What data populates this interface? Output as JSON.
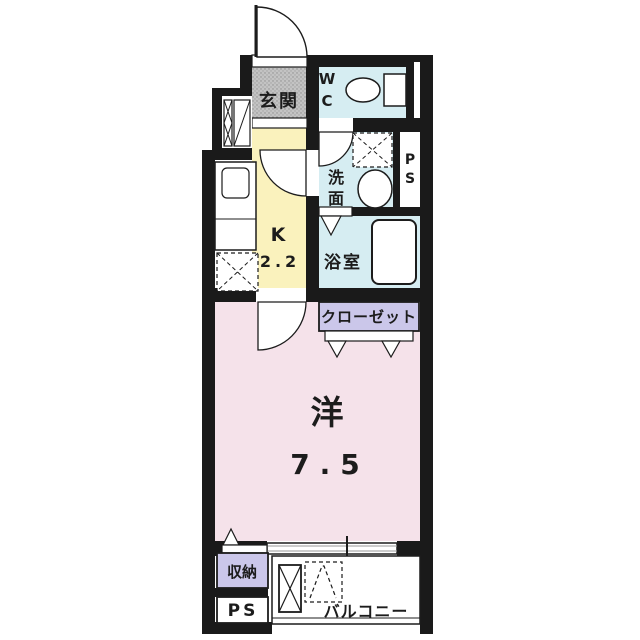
{
  "floor_plan": {
    "colors": {
      "wall": "#1a1a1a",
      "entrance": "#c3c3c3",
      "wet_area": "#d6edf2",
      "kitchen": "#faf2bd",
      "main_room": "#f5e2ea",
      "closet": "#cbc7ea",
      "white": "#ffffff"
    },
    "rooms": {
      "entrance": {
        "label": "玄関"
      },
      "toilet": {
        "line1": "W",
        "line2": "C"
      },
      "washroom": {
        "line1": "洗",
        "line2": "面"
      },
      "pipe_space_top": {
        "line1": "P",
        "line2": "S"
      },
      "bathroom": {
        "label": "浴室"
      },
      "kitchen": {
        "label": "K",
        "area": "2.2"
      },
      "closet": {
        "label": "クローゼット"
      },
      "main_room": {
        "label": "洋",
        "area": "7.5"
      },
      "storage": {
        "label": "収納"
      },
      "pipe_space_bottom": {
        "label": "PS"
      },
      "balcony": {
        "label": "バルコニー"
      }
    }
  }
}
